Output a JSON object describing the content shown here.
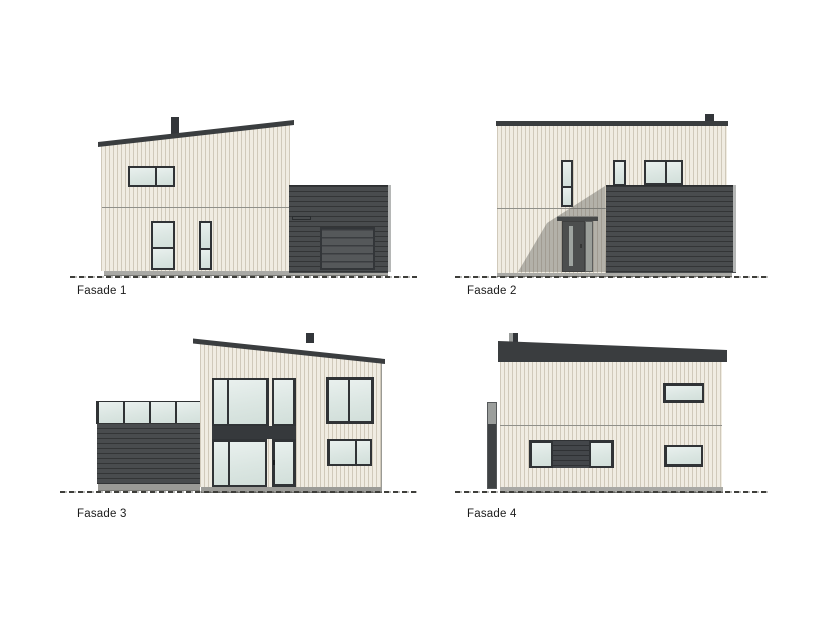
{
  "facades": [
    {
      "label": "Fasade 1"
    },
    {
      "label": "Fasade 2"
    },
    {
      "label": "Fasade 3"
    },
    {
      "label": "Fasade 4"
    }
  ],
  "colors": {
    "background": "#ffffff",
    "siding_light": "#f0ece2",
    "siding_stripe": "#b0a692",
    "cladding_dark": "#494c4e",
    "roof_dark": "#3a3d3f",
    "window_frame": "#303336",
    "glass": "#dde7e4",
    "foundation_gray": "#a9a9a5",
    "ground_line": "#3e3e3a",
    "label_text": "#1b1b1b",
    "shadow": "rgba(96,96,90,0.42)"
  }
}
